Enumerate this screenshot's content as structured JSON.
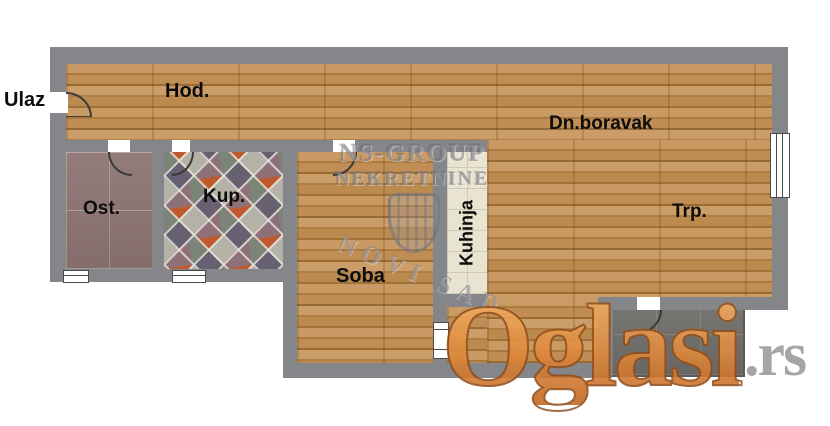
{
  "plan": {
    "labels": {
      "entrance": "Ulaz",
      "hallway": "Hod.",
      "living": "Dn.boravak",
      "dining": "Trp.",
      "storage": "Ost.",
      "bathroom": "Kup.",
      "room": "Soba",
      "kitchen": "Kuhinja"
    }
  },
  "watermark_agency": {
    "line1": "NS-GROUP",
    "line2": "NEKRETNINE",
    "city": "NOVI SAD"
  },
  "watermark_site": {
    "name": "Oglasi",
    "suffix": ".rs"
  },
  "colors": {
    "wall": "#85868a",
    "wood_floor": "#b98750",
    "kitchen_tile": "#e9e3d2",
    "terrace_tile": "#6f6d6a",
    "storage_tile": "#8b7371",
    "site_watermark_orange": "#e6954a",
    "site_watermark_gray": "#9c9c9c",
    "label_text": "#0c0c0c"
  }
}
